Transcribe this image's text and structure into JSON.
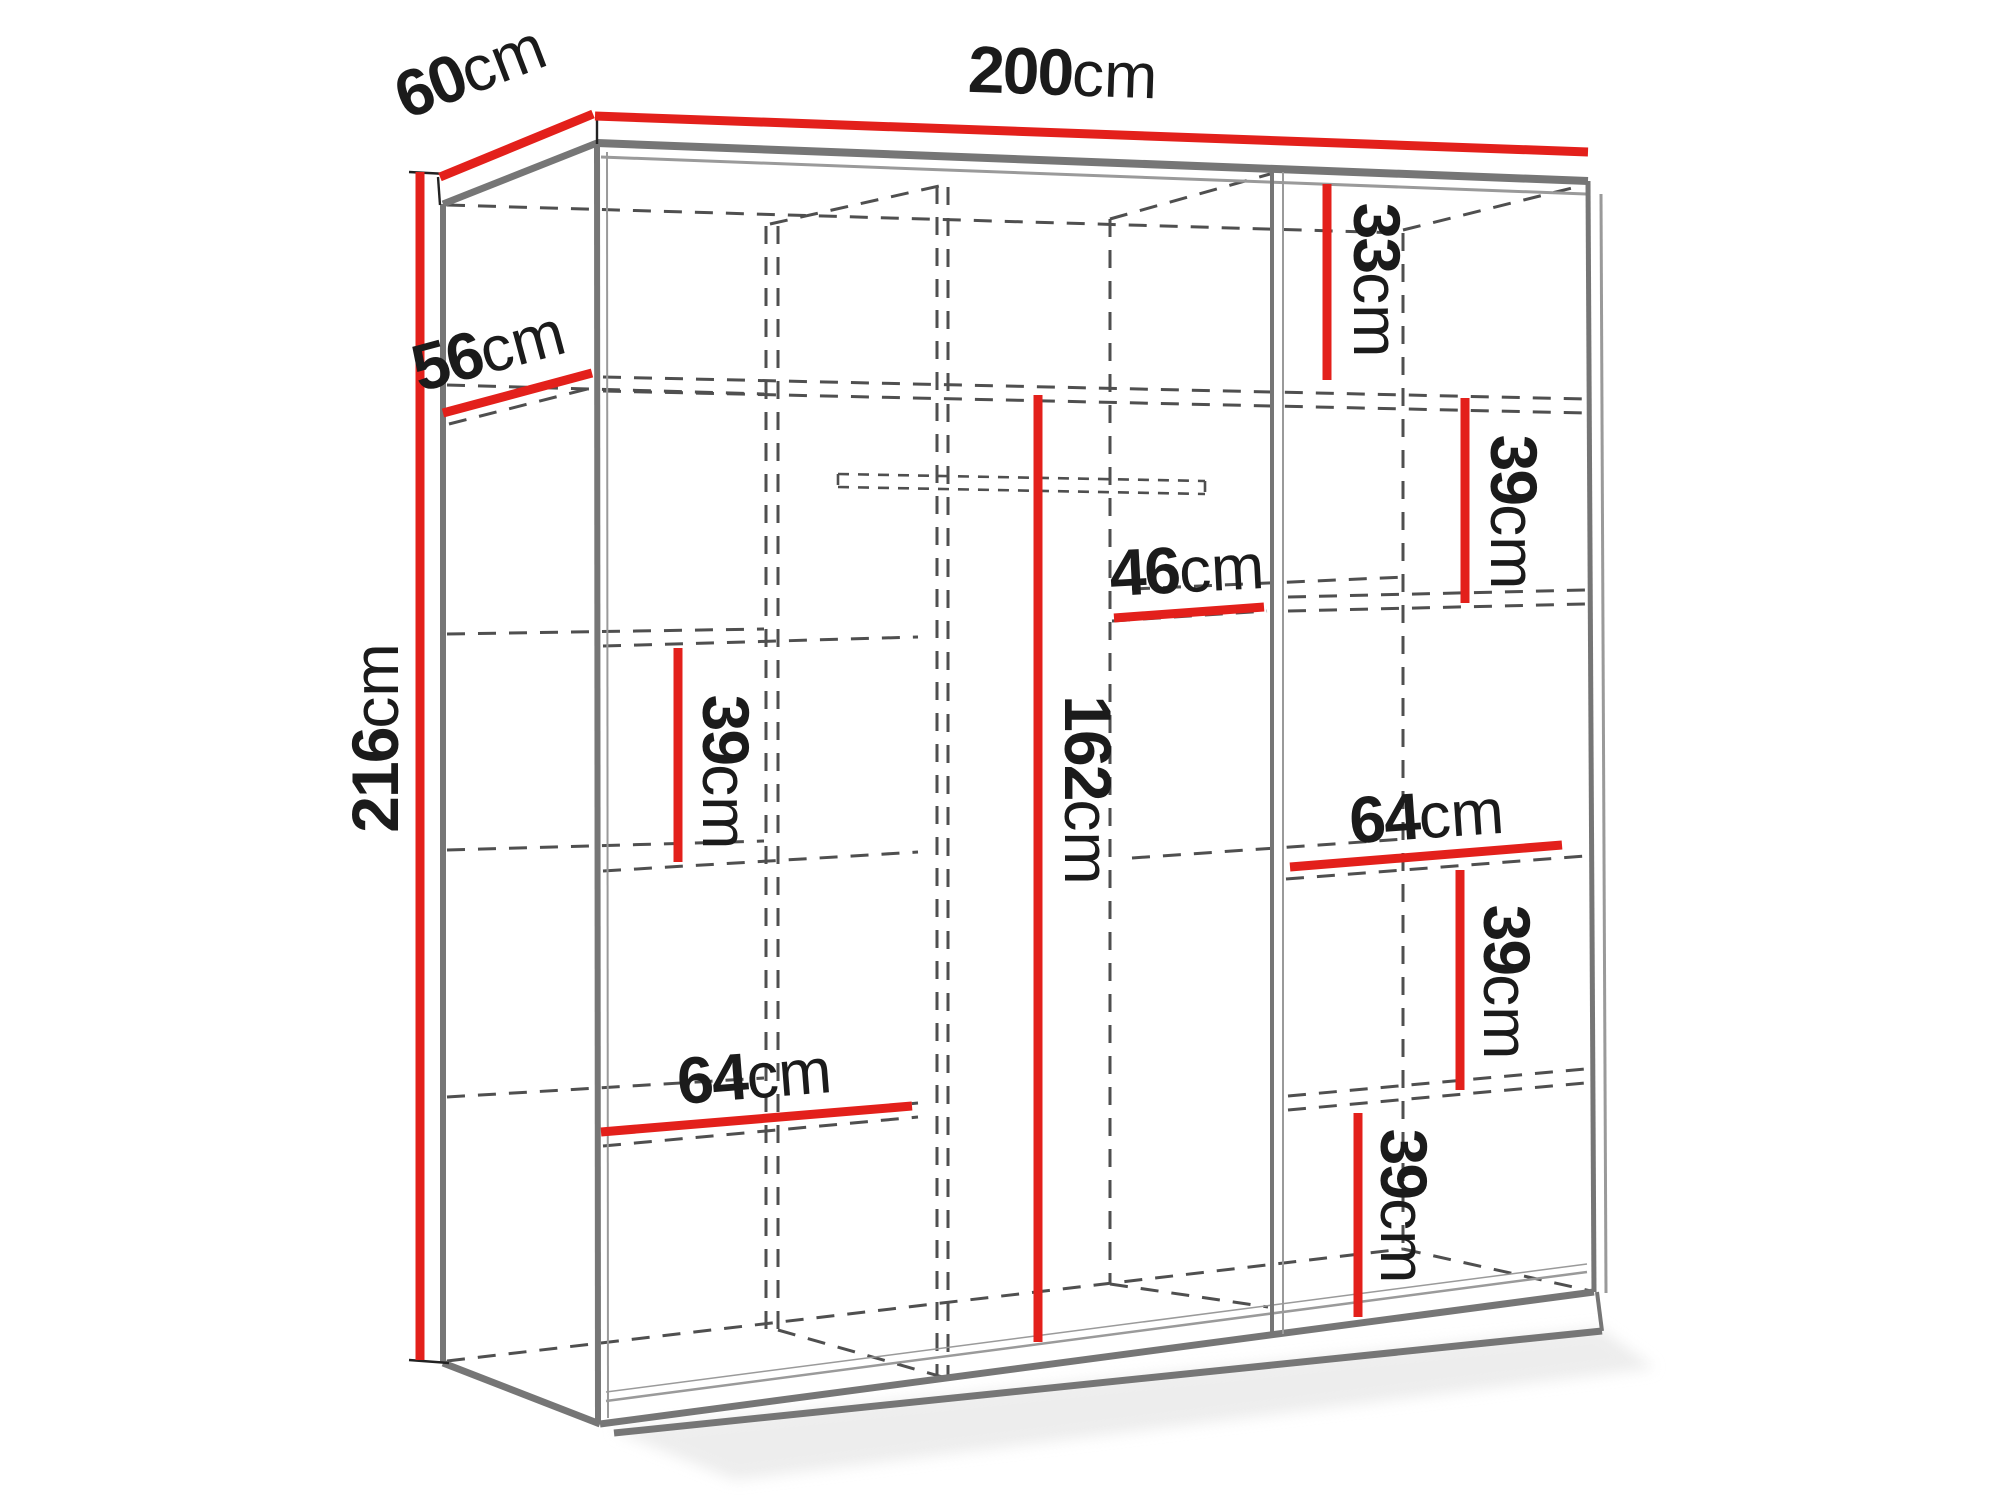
{
  "diagram_title": "Wardrobe dimension diagram",
  "colors": {
    "dimension": "#e3201b",
    "structure": "#767676",
    "structure_light": "#9a9a9a",
    "hidden": "#4f4f4f",
    "label": "#1b1b1b",
    "bg": "#ffffff"
  },
  "labels": {
    "width": {
      "value": "200",
      "unit": "cm"
    },
    "depth": {
      "value": "60",
      "unit": "cm"
    },
    "height": {
      "value": "216",
      "unit": "cm"
    },
    "shelf_depth": {
      "value": "56",
      "unit": "cm"
    },
    "left_gap": {
      "value": "39",
      "unit": "cm"
    },
    "left_shelf": {
      "value": "64",
      "unit": "cm"
    },
    "hanging_height": {
      "value": "162",
      "unit": "cm"
    },
    "hanging_width": {
      "value": "46",
      "unit": "cm"
    },
    "right_top_gap": {
      "value": "33",
      "unit": "cm"
    },
    "right_gap_upper": {
      "value": "39",
      "unit": "cm"
    },
    "right_shelf": {
      "value": "64",
      "unit": "cm"
    },
    "right_gap_mid": {
      "value": "39",
      "unit": "cm"
    },
    "right_gap_low": {
      "value": "39",
      "unit": "cm"
    }
  }
}
